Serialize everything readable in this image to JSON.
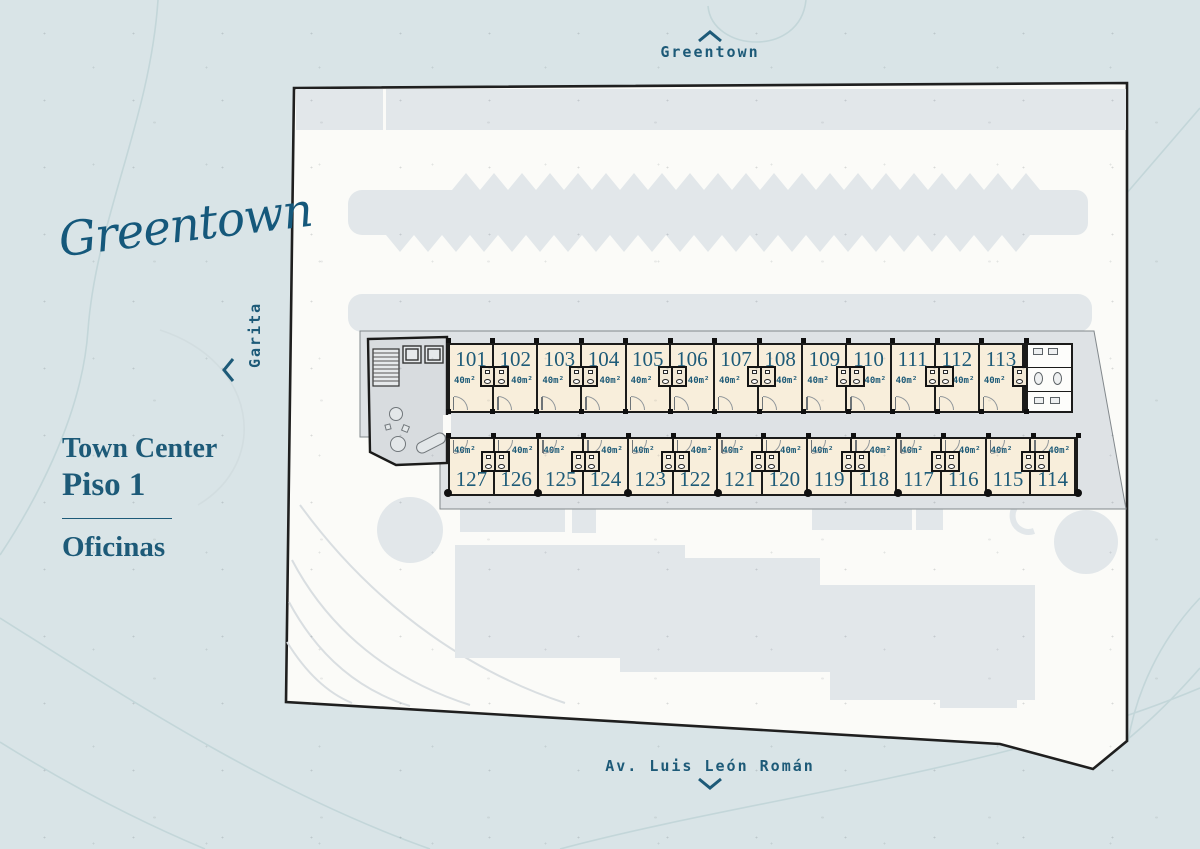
{
  "brand": {
    "logo": "Greentown"
  },
  "compass": {
    "top": {
      "label": "Greentown",
      "direction": "up"
    },
    "left": {
      "label": "Garita",
      "direction": "left"
    },
    "bottom": {
      "label": "Av. Luis León Román",
      "direction": "down"
    }
  },
  "title_block": {
    "project": "Town Center",
    "floor": "Piso 1",
    "category": "Oficinas"
  },
  "floor_plan": {
    "area_label": "40m²",
    "top_row_units": [
      {
        "number": "101",
        "area": "40m²"
      },
      {
        "number": "102",
        "area": "40m²"
      },
      {
        "number": "103",
        "area": "40m²"
      },
      {
        "number": "104",
        "area": "40m²"
      },
      {
        "number": "105",
        "area": "40m²"
      },
      {
        "number": "106",
        "area": "40m²"
      },
      {
        "number": "107",
        "area": "40m²"
      },
      {
        "number": "108",
        "area": "40m²"
      },
      {
        "number": "109",
        "area": "40m²"
      },
      {
        "number": "110",
        "area": "40m²"
      },
      {
        "number": "111",
        "area": "40m²"
      },
      {
        "number": "112",
        "area": "40m²"
      },
      {
        "number": "113",
        "area": "40m²"
      }
    ],
    "bottom_row_units": [
      {
        "number": "127",
        "area": "40m²"
      },
      {
        "number": "126",
        "area": "40m²"
      },
      {
        "number": "125",
        "area": "40m²"
      },
      {
        "number": "124",
        "area": "40m²"
      },
      {
        "number": "123",
        "area": "40m²"
      },
      {
        "number": "122",
        "area": "40m²"
      },
      {
        "number": "121",
        "area": "40m²"
      },
      {
        "number": "120",
        "area": "40m²"
      },
      {
        "number": "119",
        "area": "40m²"
      },
      {
        "number": "118",
        "area": "40m²"
      },
      {
        "number": "117",
        "area": "40m²"
      },
      {
        "number": "116",
        "area": "40m²"
      },
      {
        "number": "115",
        "area": "40m²"
      },
      {
        "number": "114",
        "area": "40m²"
      }
    ]
  },
  "colors": {
    "background": "#d9e4e7",
    "site_fill": "#fbfbf8",
    "shape_gray": "#e2e7ea",
    "unit_fill": "#f8eedb",
    "wall": "#1b1b1a",
    "accent_teal": "#1d5a78"
  }
}
